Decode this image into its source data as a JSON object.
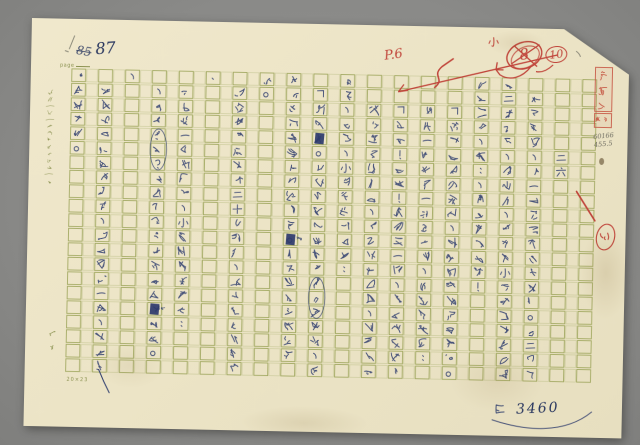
{
  "header": {
    "page_label": "page",
    "old_number": "85",
    "number": "87"
  },
  "annotations": {
    "size_note": "小",
    "rejected_number": "8",
    "approved_number": "10",
    "page_ref": "P.6",
    "chapter_edit": "女"
  },
  "stamp": {
    "name": "黃文範",
    "sub": "印鑑"
  },
  "pencil": {
    "code1": "60166",
    "code2": "455.5"
  },
  "tally": {
    "prefix": "計",
    "value": "3460"
  },
  "footer": {
    "spec": "20×23"
  },
  "brand": {
    "text": "文範"
  },
  "margin": {
    "text": "謄寫一格一字標點符號均佔一格"
  },
  "colors": {
    "ink": "#2f3e6e",
    "red": "#c0443a",
    "grid": "#96a052",
    "olive_print": "#8a9150",
    "pencil": "#8a8878",
    "paper": "#ece4c6",
    "background": "#8c8c8a"
  },
  "manuscript": {
    "chapter": "二六",
    "columns": [
      {
        "col": 1,
        "row": 1,
        "text": "是要趕回車。"
      },
      {
        "col": 2,
        "row": 2,
        "text": "我在牆缺口上邊看了，心裡嚇了一跳，對牠不了"
      },
      {
        "col": 3,
        "row": 1,
        "text": "、"
      },
      {
        "col": 4,
        "row": 2,
        "text": "、毒液好嗎？你保險不會使我受苦太久吧。"
      },
      {
        "col": 5,
        "row": 2,
        "text": "沉默了一會兒以後，小王子又說話了："
      },
      {
        "col": 6,
        "row": 1,
        "text": "·"
      },
      {
        "col": 7,
        "row": 2,
        "text": "站在離那牆還有二十公尺遠，依然什麼也沒見到"
      },
      {
        "col": 8,
        "row": 1,
        "text": "裡。"
      },
      {
        "col": 9,
        "row": 1,
        "text": "只要在那裡等著我就好啦。今天晚上我會到那"
      },
      {
        "col": 10,
        "row": 2,
        "text": "「當然囉。你看見我的腳印在沙上的起點，你"
      },
      {
        "col": 11,
        "row": 1,
        "text": "行人，以後，小王子卻又答道："
      },
      {
        "col": 12,
        "row": 3,
        "text": "我繼續往前走去，根本沒有聽到、也沒有見到什"
      },
      {
        "col": 13,
        "row": 3,
        "text": "「不錯！不錯！正是這一天，但可不是這地點。」"
      },
      {
        "col": 14,
        "row": 3,
        "text": "另外一個聲音一定答了他，因為他答道："
      },
      {
        "col": 15,
        "row": 3,
        "text": "「要是你記不住了，這不是為了什麼才好。」"
      },
      {
        "col": 16,
        "row": 1,
        "text": "對我笑著，說：、聽見他說話了！"
      },
      {
        "col": 17,
        "row": 1,
        "text": "第二天傍晚，我回去，就看見小王子坐在牆頭上，而"
      },
      {
        "col": 18,
        "row": 2,
        "text": "在井旁邊，有一堵古老石牆的頹垣。第二天晚"
      },
      {
        "col": 19,
        "row": 6,
        "text": "二六"
      }
    ],
    "marks": [
      {
        "type": "circle",
        "col": 4,
        "row_start": 5,
        "row_end": 7
      },
      {
        "type": "blob",
        "col": 4,
        "row": 17,
        "side_text": "水"
      },
      {
        "type": "blob",
        "col": 9,
        "row": 12,
        "side_text": "常"
      },
      {
        "type": "blob",
        "col": 10,
        "row": 5,
        "side_text": ""
      },
      {
        "type": "circle",
        "col": 10,
        "row_start": 15,
        "row_end": 17
      }
    ]
  }
}
